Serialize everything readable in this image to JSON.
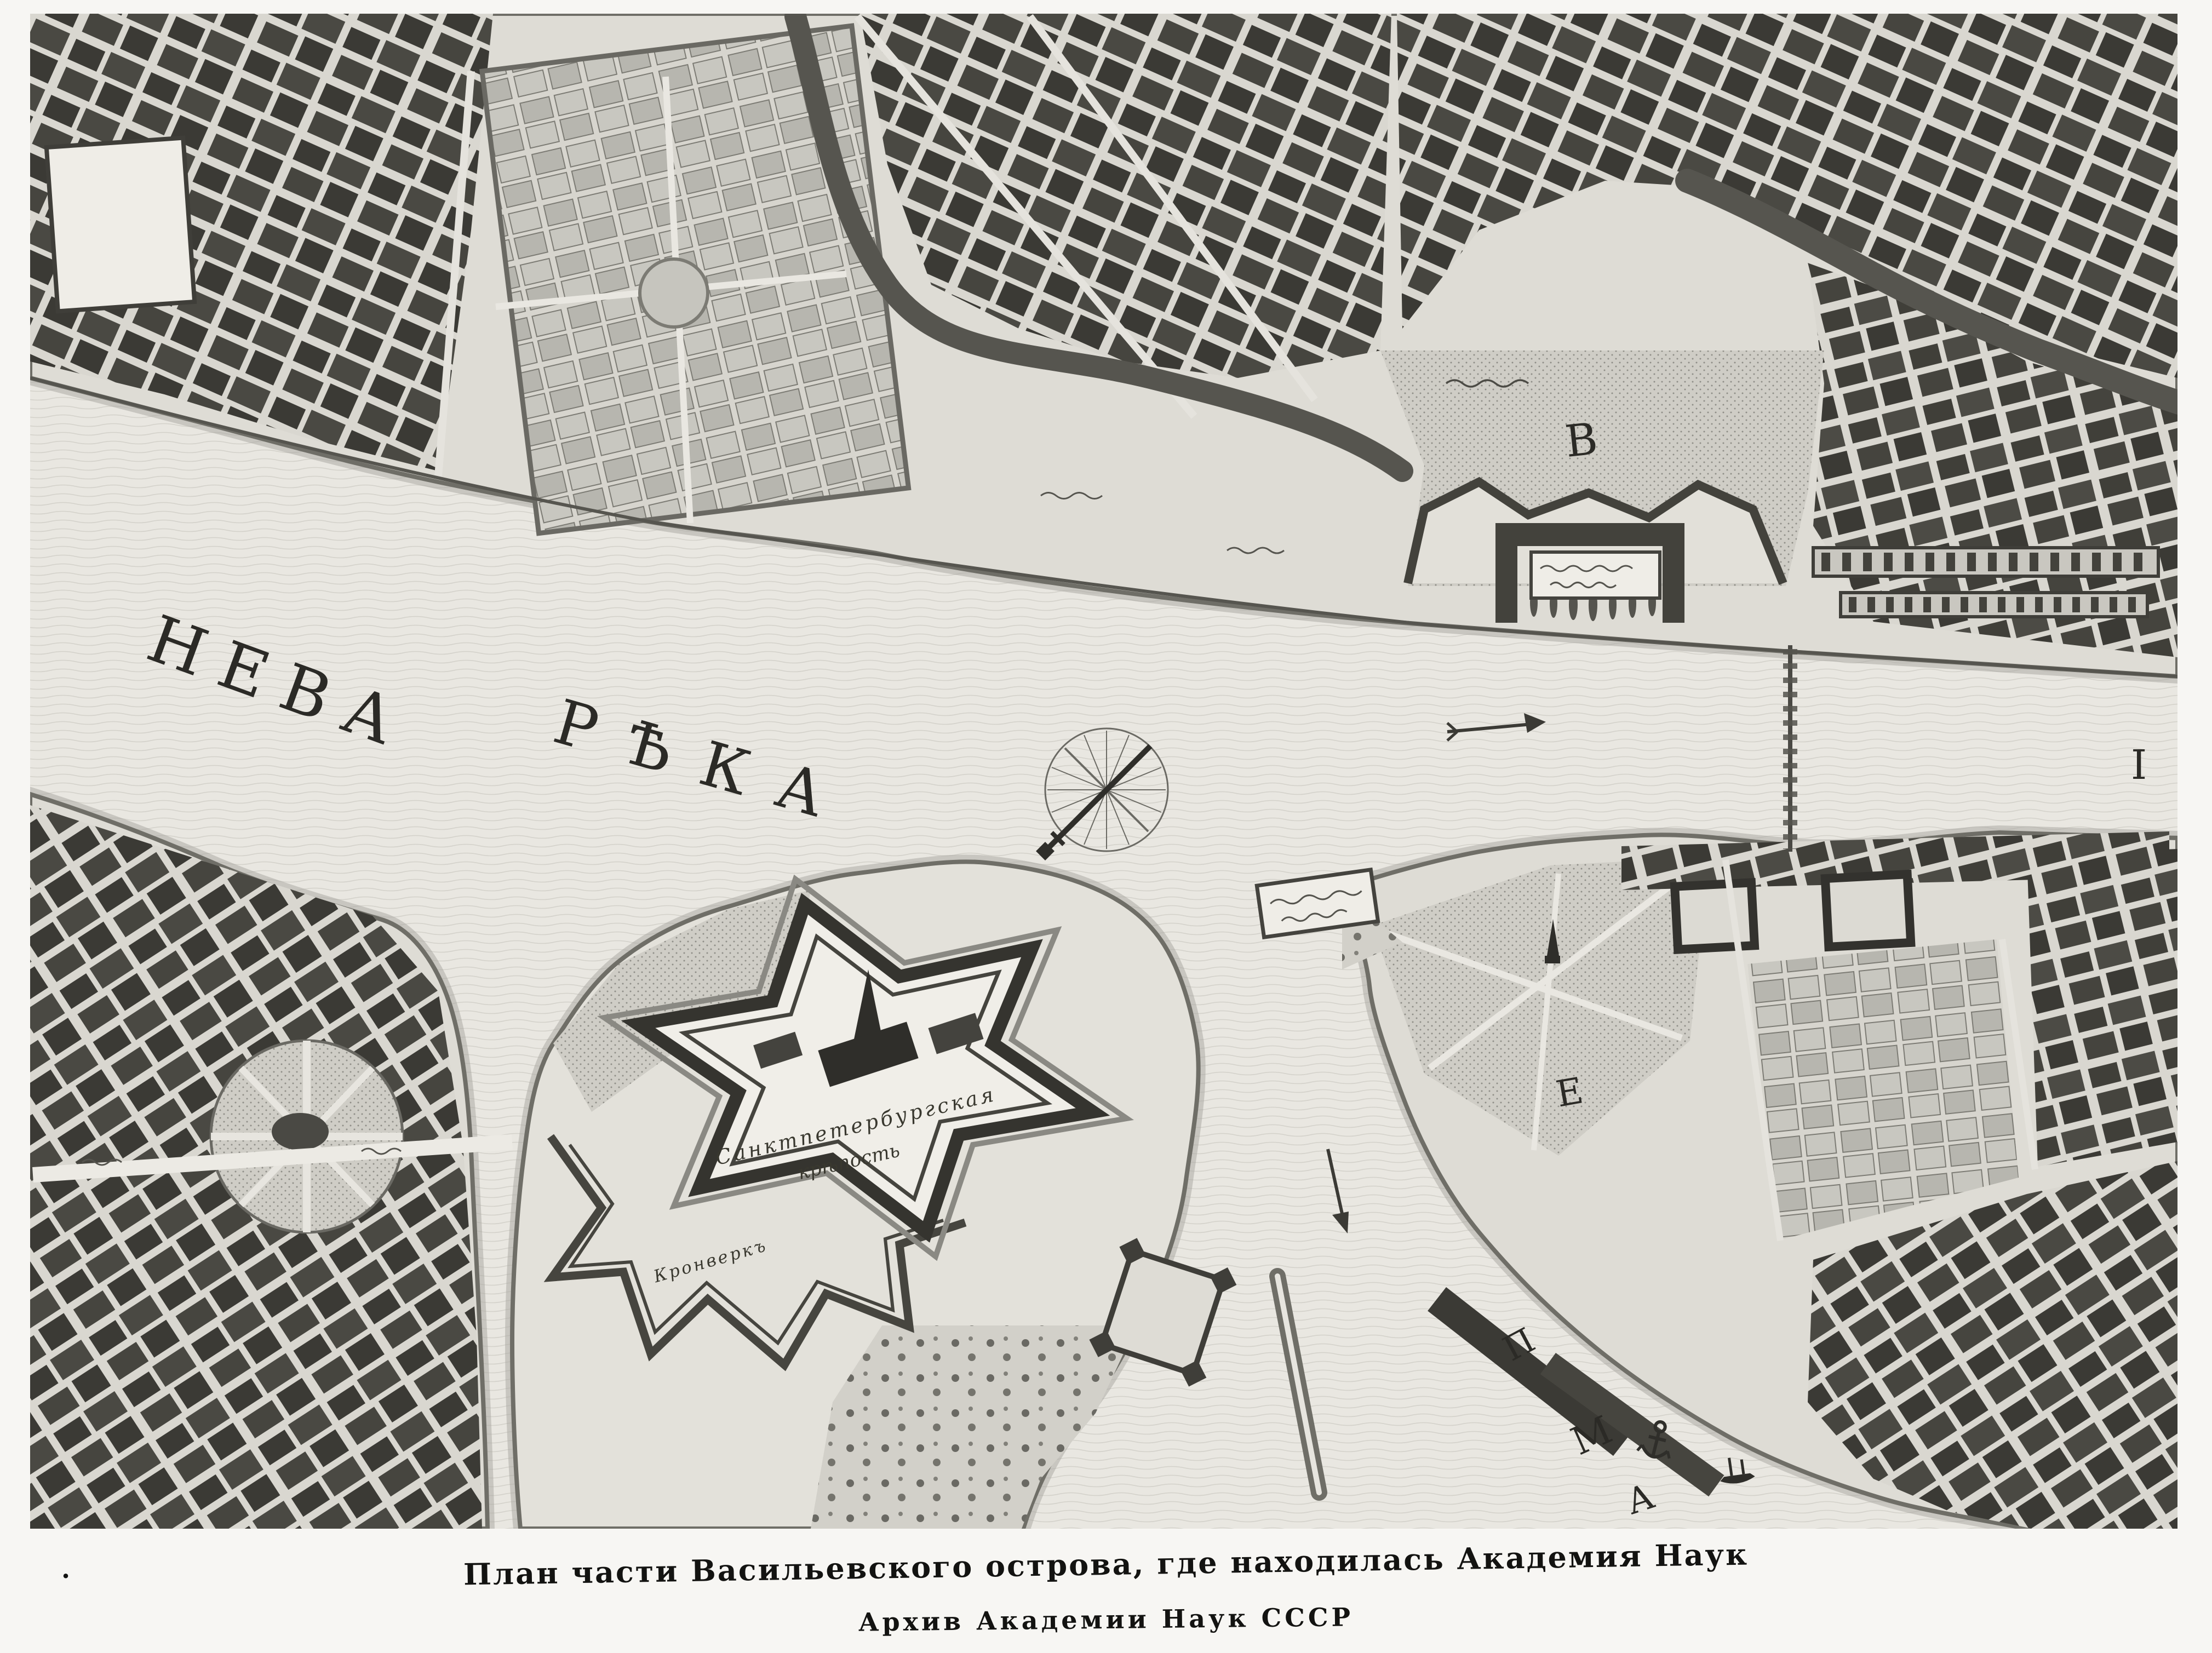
{
  "page": {
    "caption_line1": "План части Васильевского острова, где находилась Академия Наук",
    "caption_line2": "Архив Академии Наук СССР",
    "stray_mark": "."
  },
  "map": {
    "river_label": {
      "word1": "НЕВА",
      "word2": "РѢКА"
    },
    "fortress_label": {
      "line1": "Санктпетербургская",
      "line2": "крѣпость"
    },
    "kronverk_label": "Кронверкъ",
    "markers": {
      "admiralty_meadow": "В",
      "island_field": "Е",
      "right_edge": "I",
      "wharf_p": "П",
      "wharf_m": "М",
      "wharf_a": "А"
    },
    "icons": {
      "compass": "compass-rose",
      "flow_arrows": "river-flow-arrow",
      "anchor": "anchor",
      "ship": "sailing-ship",
      "bridge": "pontoon-bridge"
    },
    "colors": {
      "ink": "#3b3a35",
      "paper_margin": "#f7f6f3",
      "water": "#e9e7e1",
      "land": "#dedcd5",
      "shore": "#6f6e67",
      "stipple": "#8f8e88"
    }
  }
}
